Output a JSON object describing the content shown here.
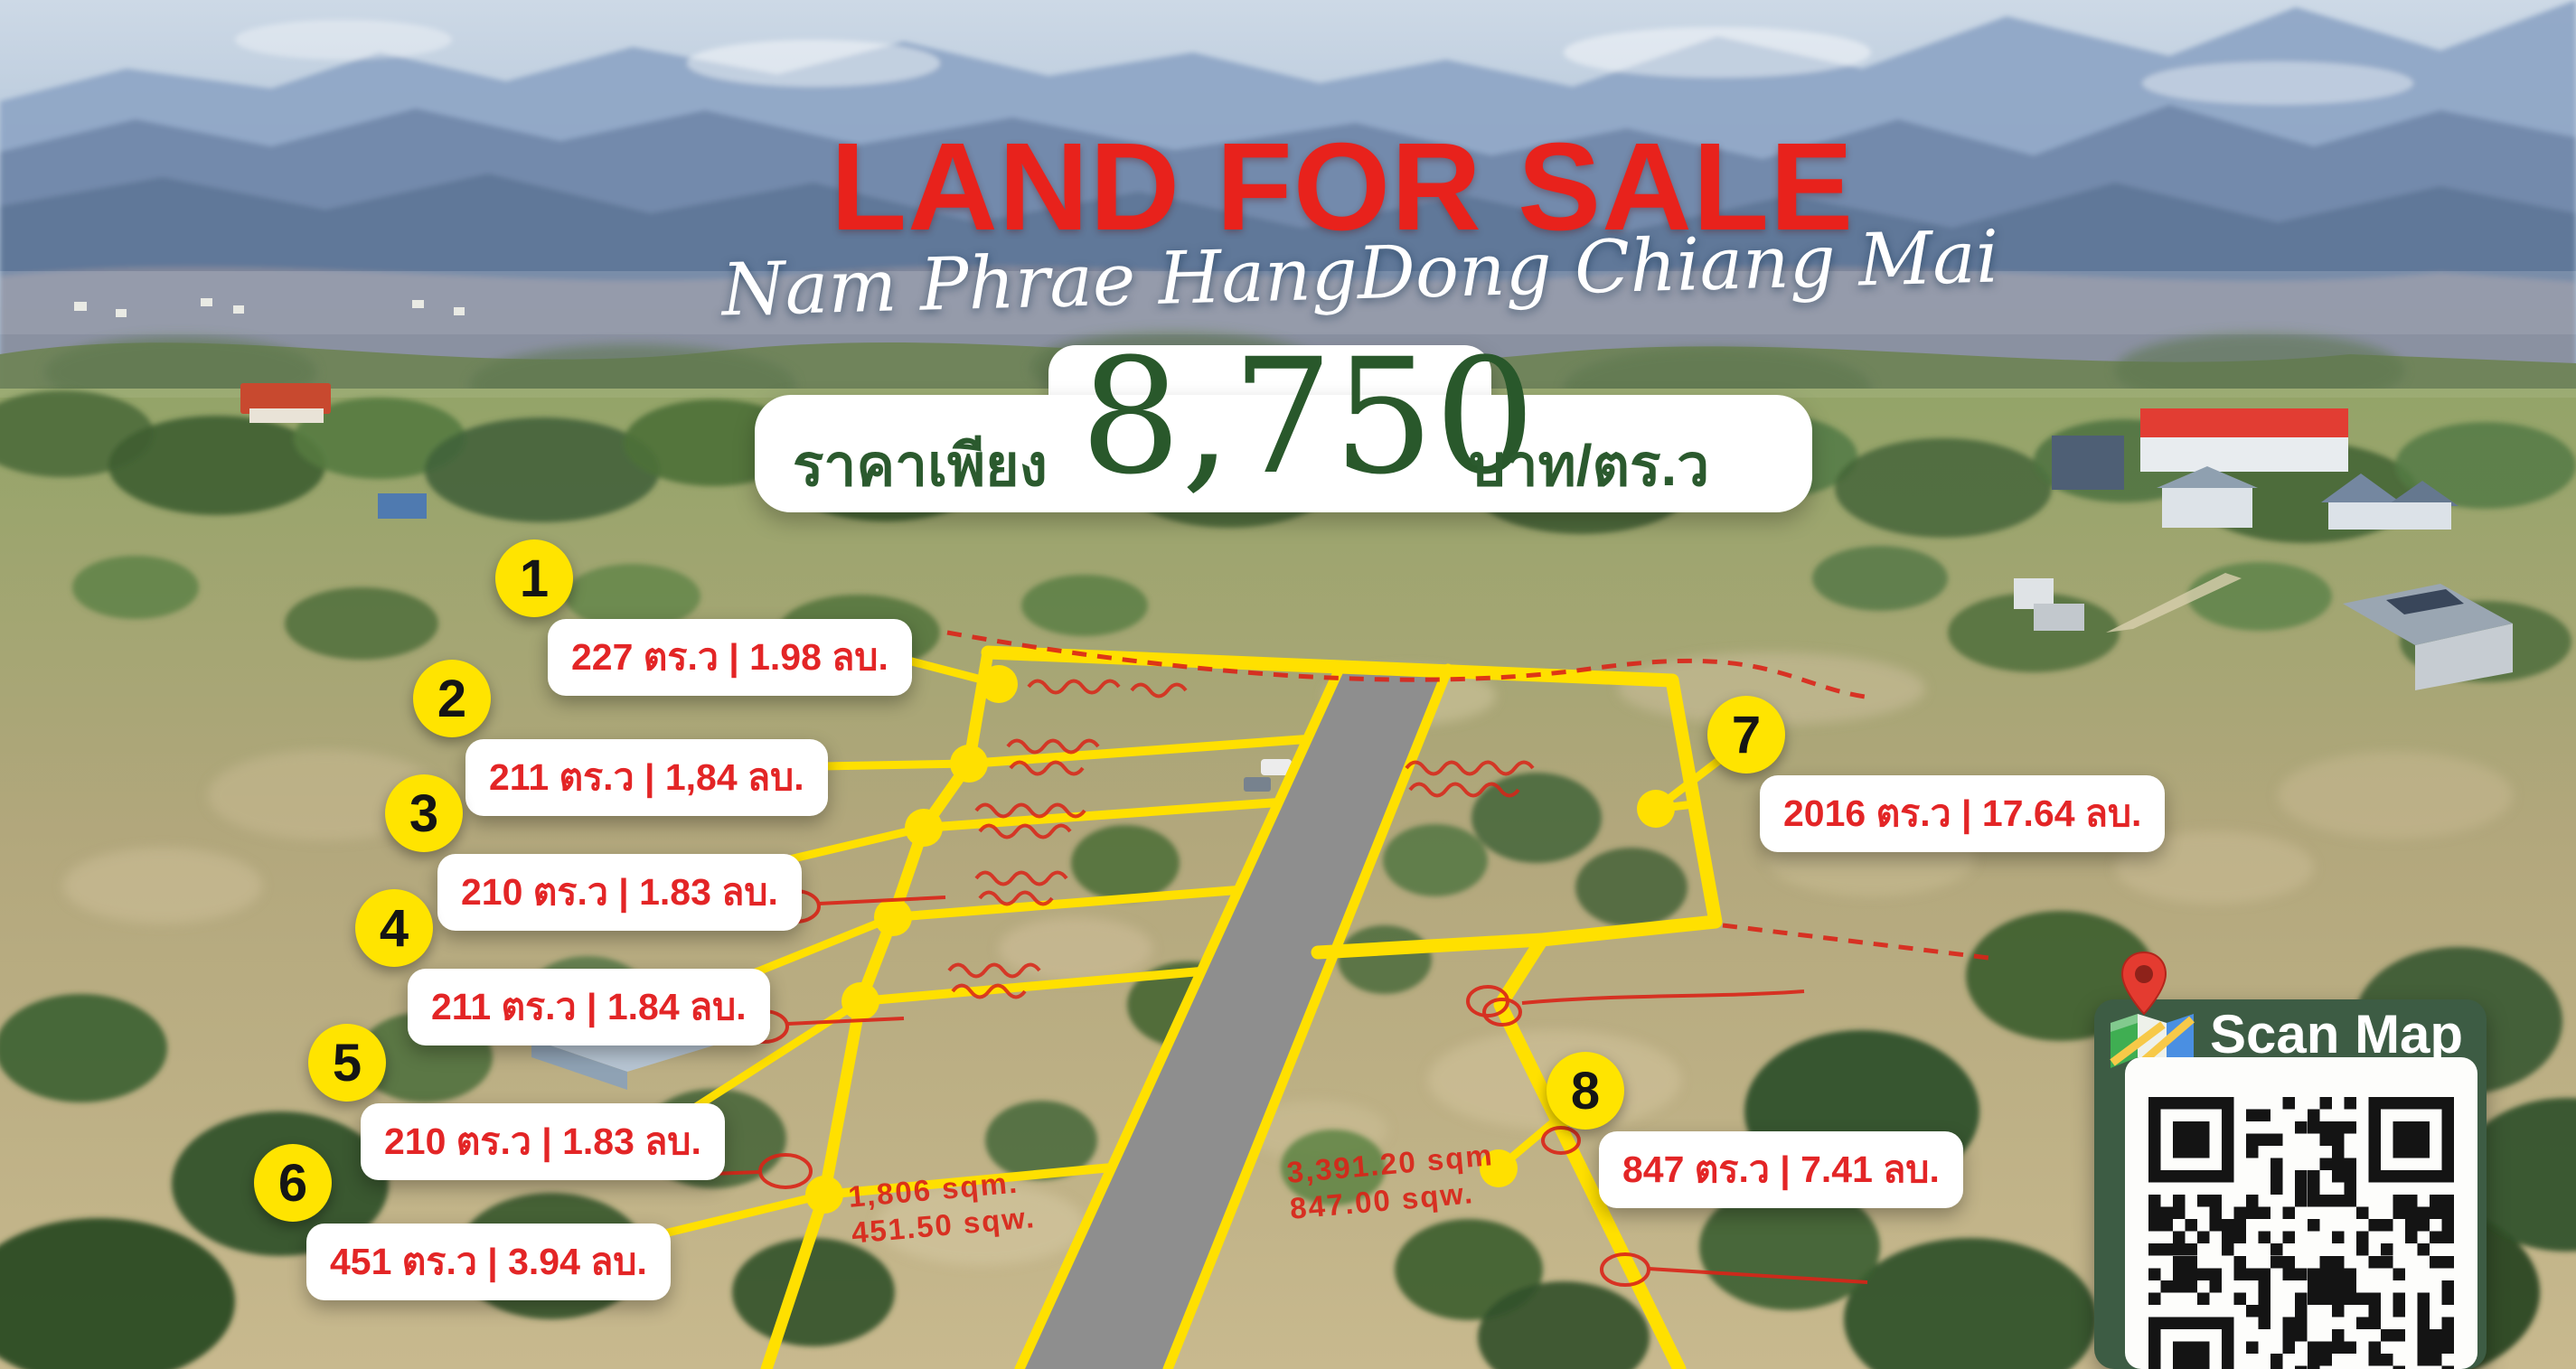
{
  "title": "LAND FOR SALE",
  "subtitle": "Nam Phrae HangDong Chiang Mai",
  "price": {
    "prefix": "ราคาเพียง",
    "amount": "8,750",
    "unit": "บาท/ตร.ว"
  },
  "plots": [
    {
      "number": "1",
      "label": "227 ตร.ว | 1.98 ลบ."
    },
    {
      "number": "2",
      "label": "211 ตร.ว | 1,84 ลบ."
    },
    {
      "number": "3",
      "label": "210 ตร.ว | 1.83 ลบ."
    },
    {
      "number": "4",
      "label": "211 ตร.ว | 1.84 ลบ."
    },
    {
      "number": "5",
      "label": "210 ตร.ว | 1.83 ลบ."
    },
    {
      "number": "6",
      "label": "451 ตร.ว | 3.94 ลบ."
    },
    {
      "number": "7",
      "label": "2016 ตร.ว | 17.64 ลบ."
    },
    {
      "number": "8",
      "label": "847 ตร.ว | 7.41 ลบ."
    }
  ],
  "survey_annotations": [
    {
      "plot": "6",
      "lines": [
        "1,806 sqm.",
        "451.50 sqw."
      ]
    },
    {
      "plot": "8",
      "lines": [
        "3,391.20 sqm",
        "847.00 sqw."
      ]
    }
  ],
  "scan_map": {
    "label": "Scan Map",
    "icons": [
      "location-pin-icon",
      "map-icon",
      "qr-code"
    ]
  },
  "colors": {
    "title_red": "#e8221c",
    "label_red": "#e32526",
    "price_green": "#2b5a2e",
    "panel_green": "#3d5c44",
    "boundary_yellow": "#ffe000",
    "badge_yellow": "#ffe400",
    "road_grey": "#8e8e8e",
    "survey_red": "#da2418"
  }
}
